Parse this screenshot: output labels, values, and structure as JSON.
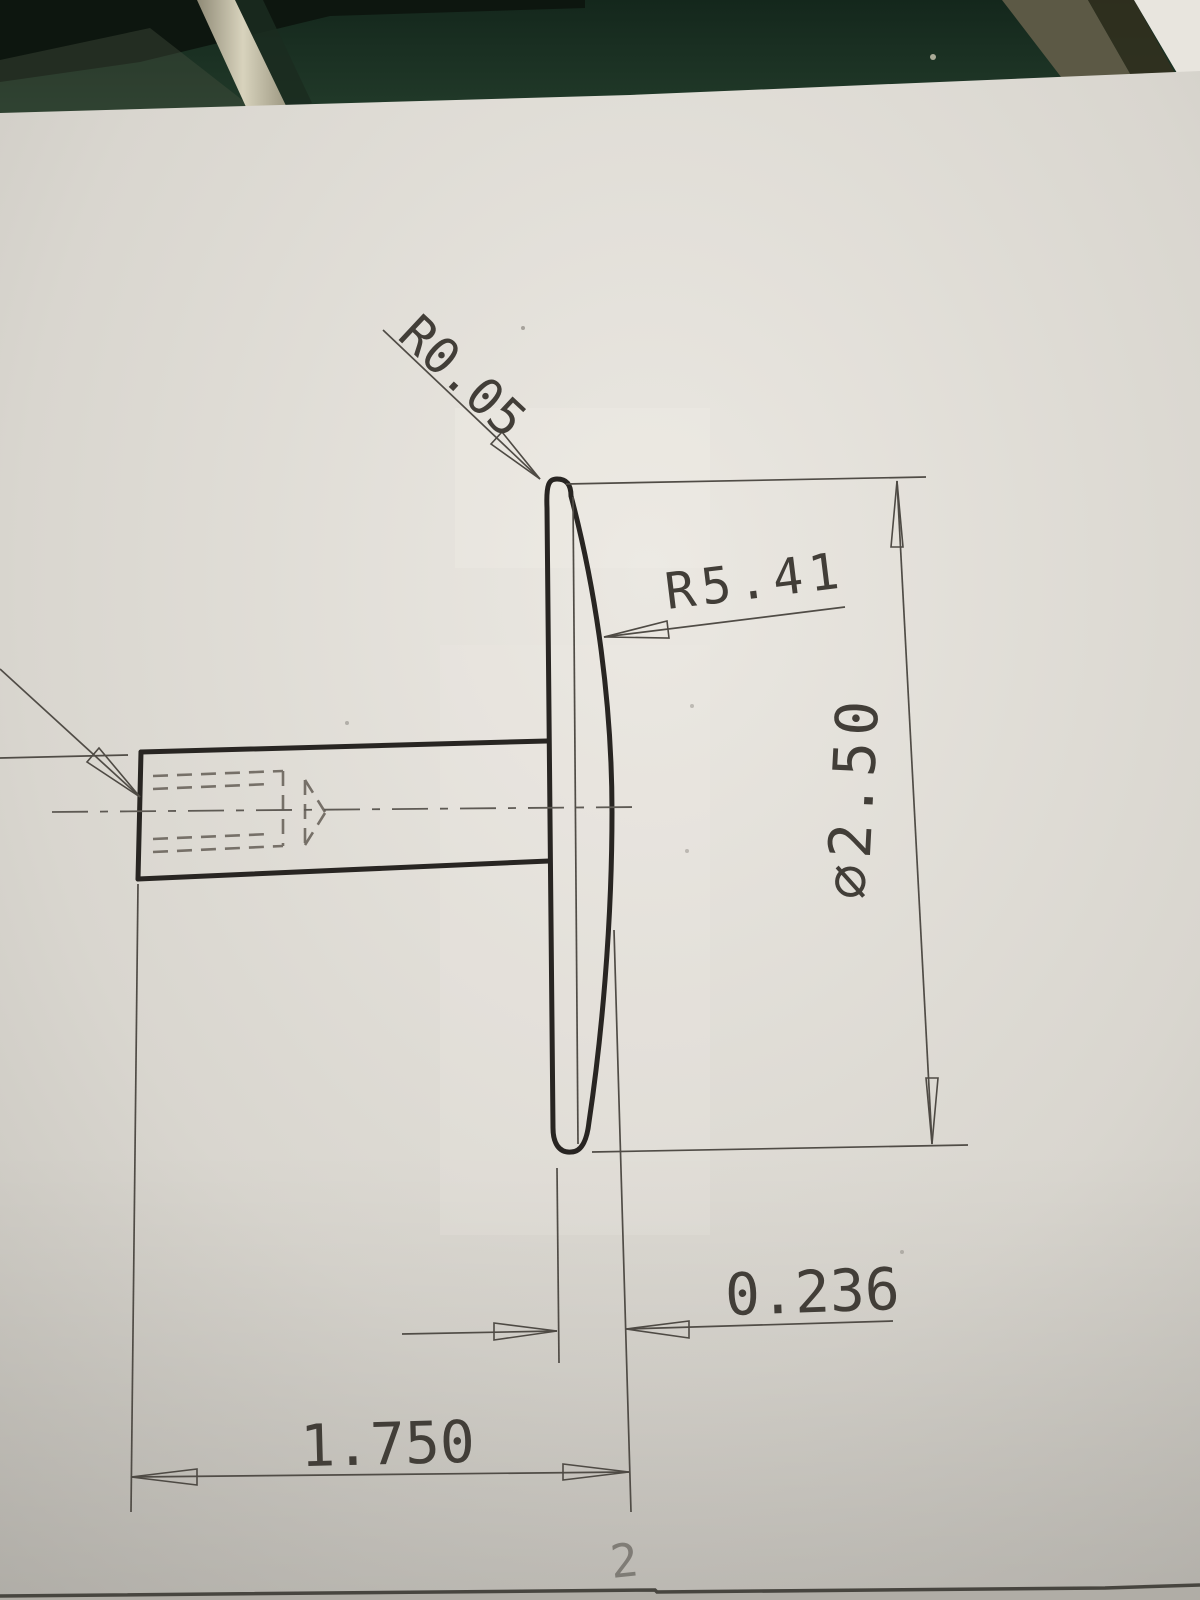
{
  "scene": {
    "type": "photo of an engineering drawing on paper lying on a green workbench",
    "table_color": "#1e3627",
    "rod_color": "#bdb7a1",
    "paper_color": "#d9d6cf",
    "line_color": "#2a2724"
  },
  "drawing": {
    "view": "side view of a pin with a spherical domed cap and hidden tapped hole in the shank",
    "labels": {
      "edge_radius": "R0.05",
      "dome_radius": "R5.41",
      "head_diameter": "⌀2.50",
      "head_thickness": "0.236",
      "overall_length": "1.750"
    },
    "pencil_mark": "2"
  }
}
